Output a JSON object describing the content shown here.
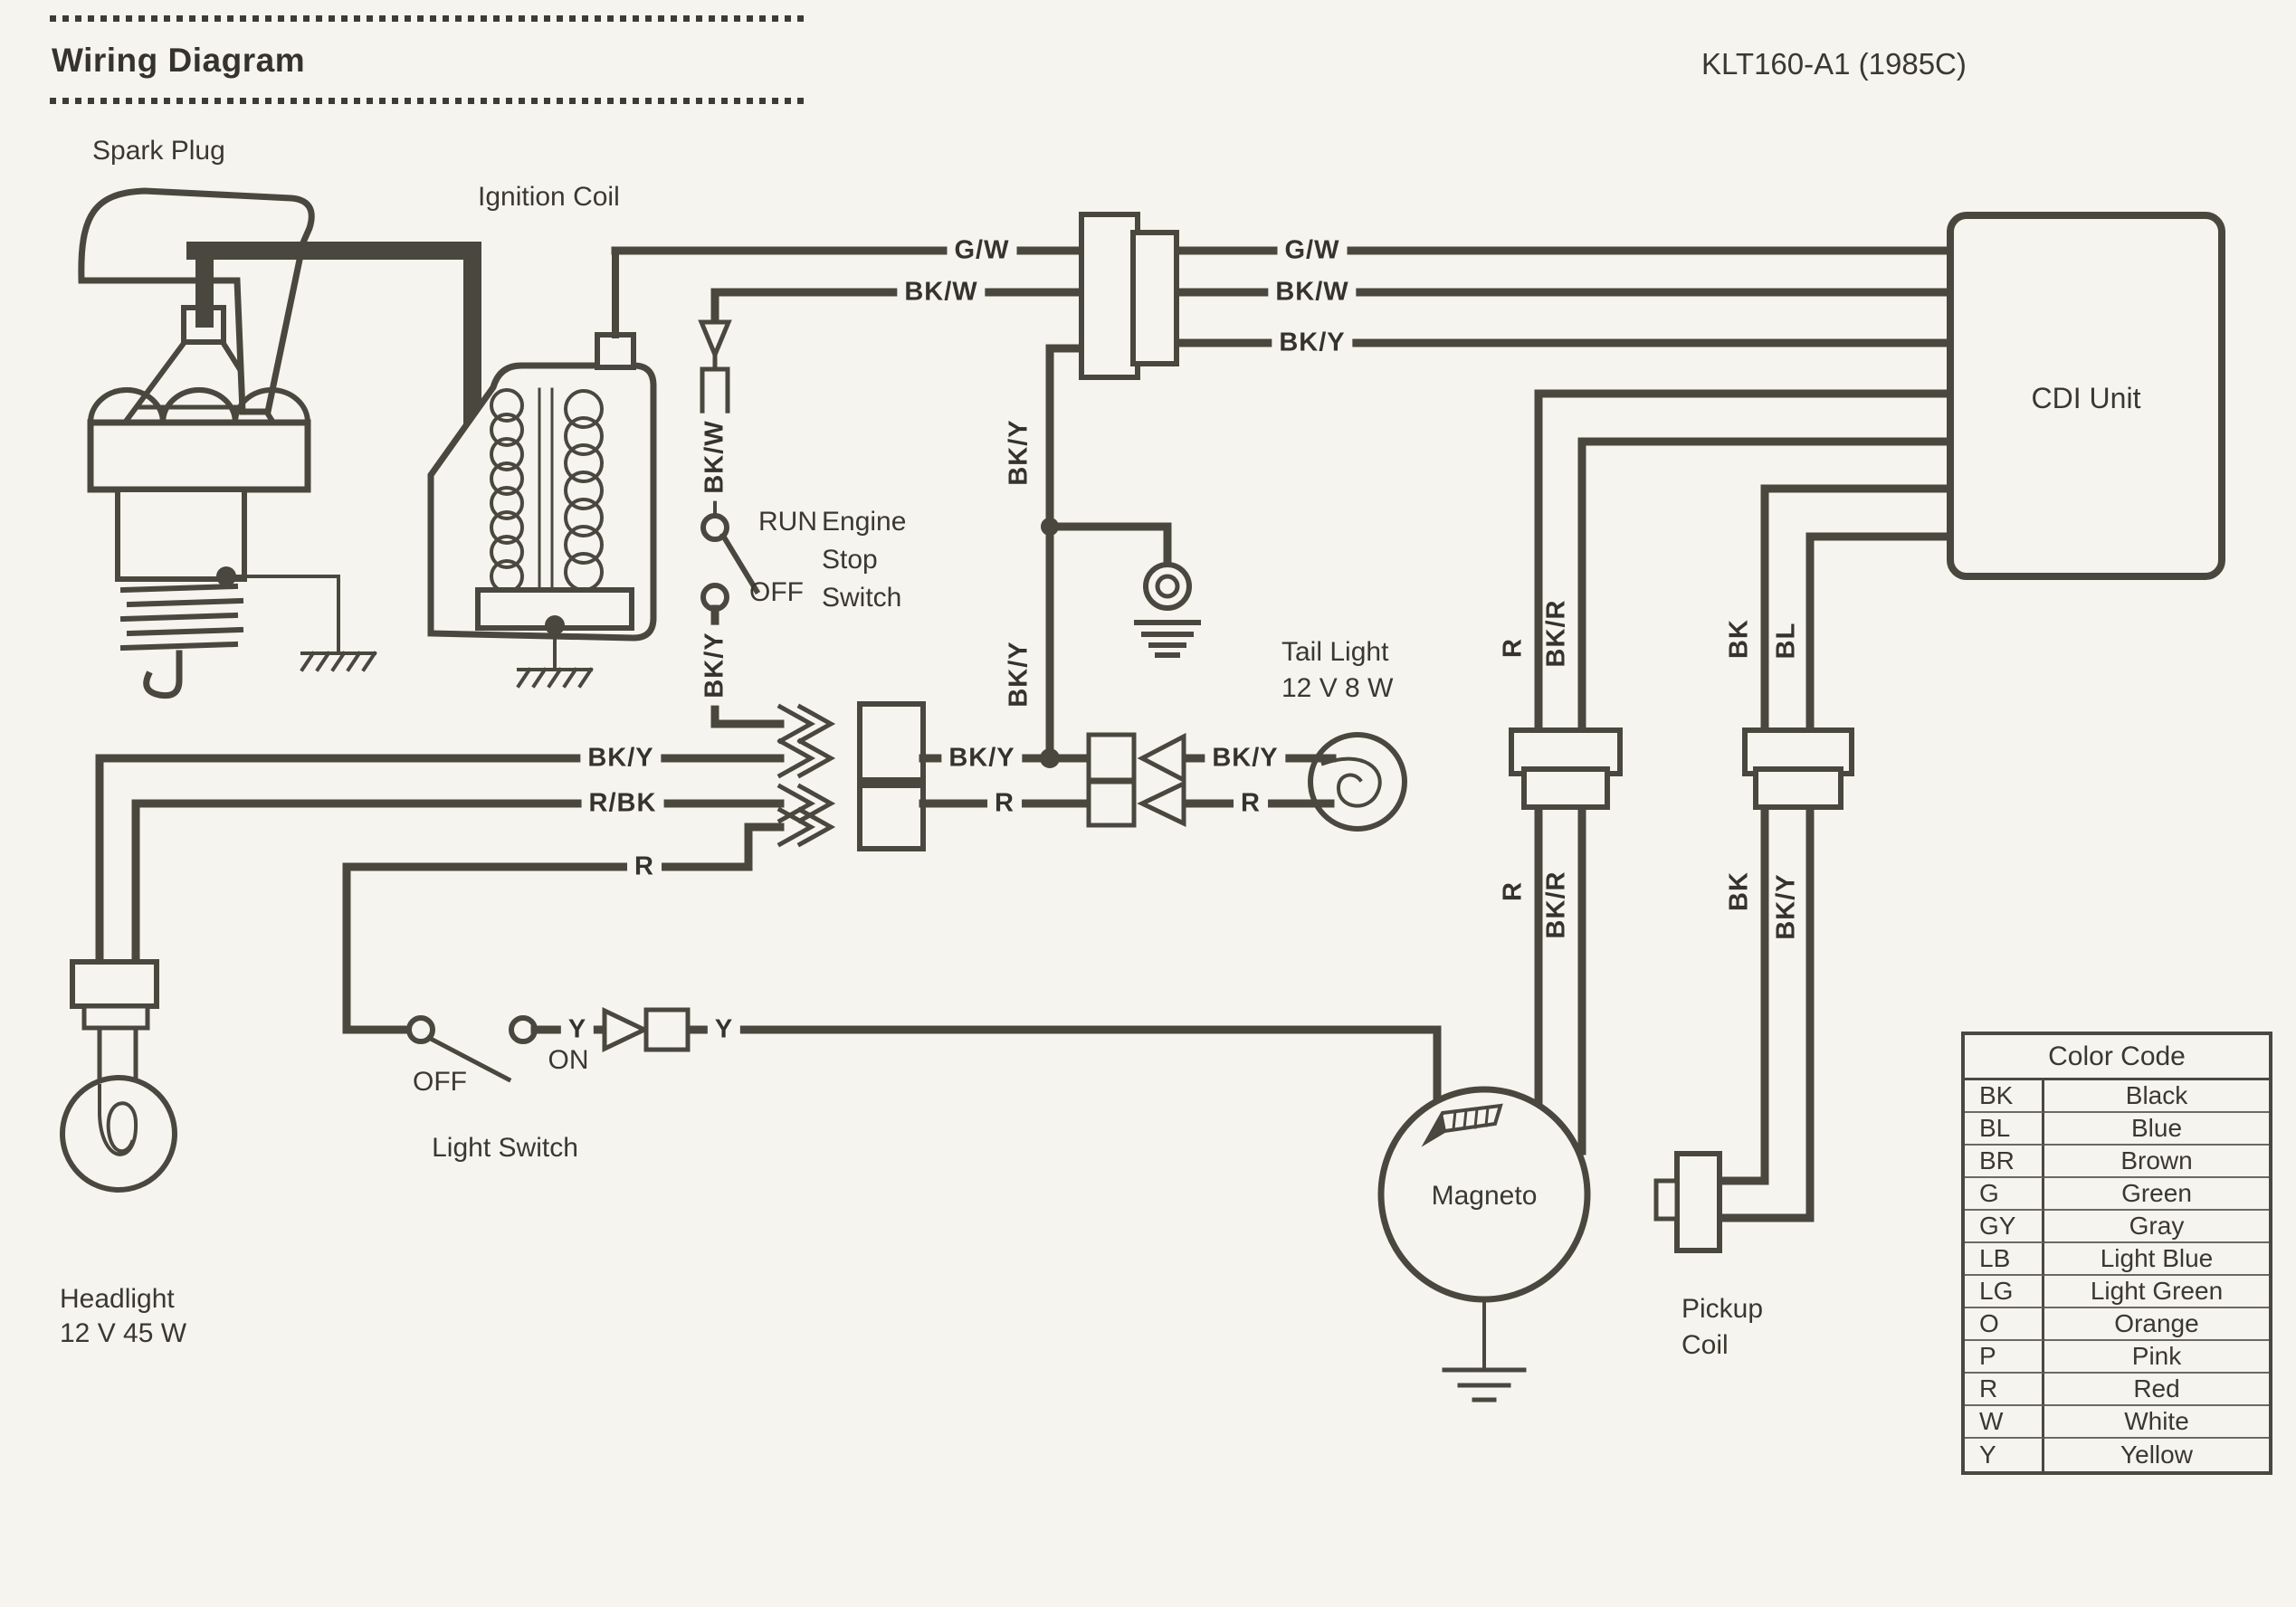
{
  "header": {
    "title": "Wiring Diagram",
    "model": "KLT160-A1 (1985C)"
  },
  "components": {
    "spark_plug": "Spark Plug",
    "ignition_coil": "Ignition Coil",
    "engine_stop_switch": {
      "run": "RUN",
      "off": "OFF",
      "line1": "Engine",
      "line2": "Stop",
      "line3": "Switch"
    },
    "tail_light": {
      "name": "Tail Light",
      "rating": "12 V  8 W"
    },
    "cdi_unit": "CDI Unit",
    "magneto": "Magneto",
    "pickup_coil": {
      "line1": "Pickup",
      "line2": "Coil"
    },
    "headlight": {
      "name": "Headlight",
      "rating": "12 V 45 W"
    },
    "light_switch": {
      "name": "Light Switch",
      "off": "OFF",
      "on": "ON"
    }
  },
  "wires": {
    "gw": "G/W",
    "bkw": "BK/W",
    "bky": "BK/Y",
    "rbk": "R/BK",
    "r": "R",
    "y": "Y",
    "bkr": "BK/R",
    "bk": "BK",
    "bl": "BL"
  },
  "color_code": {
    "title": "Color Code",
    "rows": [
      {
        "code": "BK",
        "name": "Black"
      },
      {
        "code": "BL",
        "name": "Blue"
      },
      {
        "code": "BR",
        "name": "Brown"
      },
      {
        "code": "G",
        "name": "Green"
      },
      {
        "code": "GY",
        "name": "Gray"
      },
      {
        "code": "LB",
        "name": "Light Blue"
      },
      {
        "code": "LG",
        "name": "Light Green"
      },
      {
        "code": "O",
        "name": "Orange"
      },
      {
        "code": "P",
        "name": "Pink"
      },
      {
        "code": "R",
        "name": "Red"
      },
      {
        "code": "W",
        "name": "White"
      },
      {
        "code": "Y",
        "name": "Yellow"
      }
    ]
  }
}
